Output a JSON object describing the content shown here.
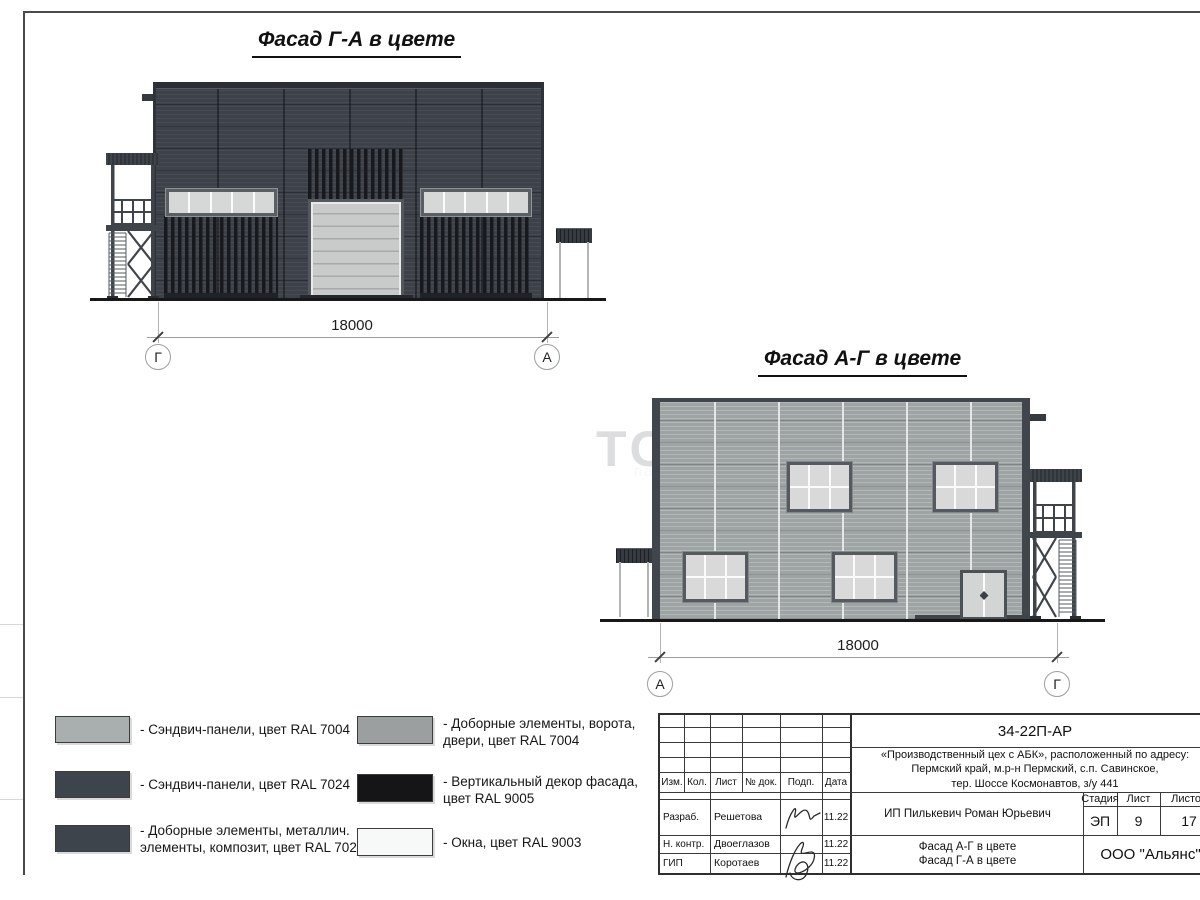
{
  "colors": {
    "ral7004_body": "#9ea3a4",
    "ral7024_body": "#3d424a",
    "ral9005_stripes": "#17191c",
    "ral9003_windows": "#f7f8f8",
    "gate_panel": "#c9cbca",
    "window_pane": "#d6d8d7",
    "swatch_ral7004_panels": "#a9aeae",
    "swatch_ral7024_panels": "#3e444b",
    "swatch_ral7024_elements": "#3e444b",
    "swatch_ral7004_elements": "#9b9fa0",
    "swatch_ral9005": "#151518",
    "swatch_ral9003": "#f7f8f8"
  },
  "facade1": {
    "title": "Фасад Г-А в цвете",
    "dimension": "18000",
    "axis_left": "Г",
    "axis_right": "А"
  },
  "facade2": {
    "title": "Фасад А-Г в цвете",
    "dimension": "18000",
    "axis_left": "А",
    "axis_right": "Г"
  },
  "watermark": {
    "line1": "ТС",
    "line2": "пания"
  },
  "legend": {
    "items": [
      {
        "swatch": "#a9aeae",
        "label": "- Сэндвич-панели, цвет RAL 7004"
      },
      {
        "swatch": "#3e444b",
        "label": "- Сэндвич-панели, цвет RAL 7024"
      },
      {
        "swatch": "#3e444b",
        "label": "- Доборные элементы, металлич.\nэлементы, композит, цвет RAL 7024"
      },
      {
        "swatch": "#9b9fa0",
        "label": "- Доборные элементы, ворота,\nдвери, цвет RAL 7004"
      },
      {
        "swatch": "#151518",
        "label": "- Вертикальный декор фасада,\nцвет RAL 9005"
      },
      {
        "swatch": "#f7f8f8",
        "label": "- Окна, цвет RAL 9003"
      }
    ]
  },
  "titleblock": {
    "doc_code": "34-22П-АР",
    "project": {
      "line1": "«Производственный цех с АБК», расположенный по адресу:",
      "line2": "Пермский край, м.р-н Пермский, с.п. Савинское,",
      "line3": "тер. Шоссе Космонавтов, з/у 441"
    },
    "headers": {
      "izm": "Изм.",
      "kol": "Кол.",
      "list": "Лист",
      "doc": "№ док.",
      "podp": "Подп.",
      "data": "Дата",
      "stage": "Стадия",
      "sheet": "Лист",
      "sheets": "Листов"
    },
    "signers": [
      {
        "role": "Разраб.",
        "name": "Решетова",
        "date": "11.22"
      },
      {
        "role": "Н. контр.",
        "name": "Двоеглазов",
        "date": "11.22"
      },
      {
        "role": "ГИП",
        "name": "Коротаев",
        "date": "11.22"
      }
    ],
    "client": "ИП Пилькевич Роман Юрьевич",
    "stage": "ЭП",
    "sheet_no": "9",
    "sheets_total": "17",
    "drawing_name": "Фасад А-Г в цвете\nФасад Г-А в цвете",
    "company": "ООО \"Альянс\""
  }
}
